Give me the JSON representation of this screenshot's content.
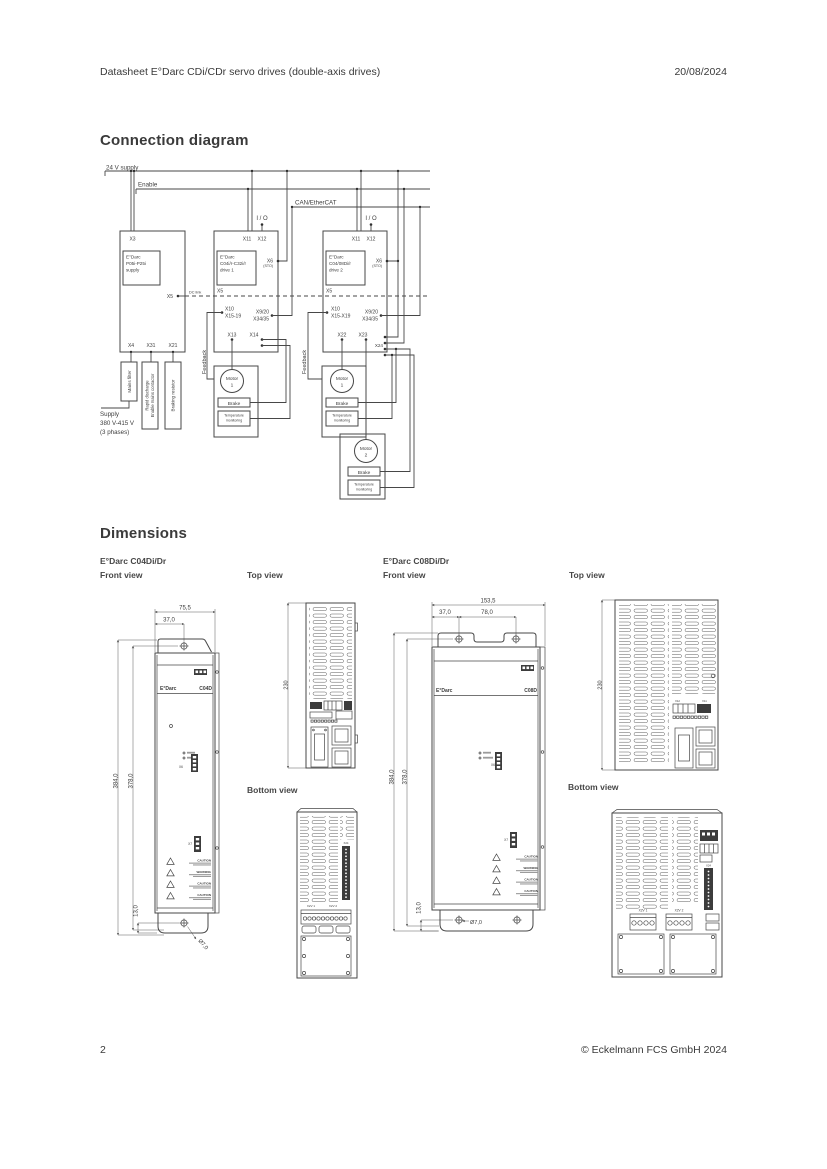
{
  "header": {
    "title": "Datasheet E°Darc CDi/CDr servo drives (double-axis drives)",
    "date": "20/08/2024"
  },
  "sections": {
    "connection": "Connection diagram",
    "dimensions": "Dimensions"
  },
  "footer": {
    "page": "2",
    "copyright": "© Eckelmann FCS GmbH 2024"
  },
  "diagram": {
    "bus": {
      "supply24": "24 V supply",
      "enable": "Enable",
      "can": "CAN/EtherCAT",
      "io1": "I / O",
      "io2": "I / O",
      "dc_link": "DC link"
    },
    "supply": {
      "x3": "X3",
      "name1": "E°Darc",
      "name2": "P05i-P25i",
      "name3": "supply",
      "x5": "X5",
      "x4": "X4",
      "x31": "X31",
      "x21": "X21"
    },
    "acc": {
      "mains_filter": "Mains filter",
      "rapid1": "Rapid discharge",
      "rapid2": "Enable mains contactor",
      "braking": "Braking resistor",
      "supply1": "Supply",
      "supply2": "380 V-415 V",
      "supply3": "(3 phases)"
    },
    "d1": {
      "x11": "X11",
      "x12": "X12",
      "name1": "E°Darc",
      "name2": "C04i/r-C32i/r",
      "name3": "drive 1",
      "x6": "X6",
      "sto": "(STO)",
      "x5": "X5",
      "x10": "X10",
      "x15": "X15-19",
      "x920": "X9/20",
      "x3435": "X34/35",
      "x13": "X13",
      "x14": "X14",
      "feedback": "Feedback"
    },
    "d2": {
      "x11": "X11",
      "x12": "X12",
      "name1": "E°Darc",
      "name2": "C04/08Di/r",
      "name3": "drive 2",
      "x6": "X6",
      "sto": "(STO)",
      "x5": "X5",
      "x10": "X10",
      "x15": "X15-X19",
      "x920": "X9/20",
      "x3435": "X34/35",
      "x22": "X22",
      "x23": "X23",
      "x24": "X24",
      "feedback": "Feedback"
    },
    "motor": {
      "label": "Motor",
      "n1": "1",
      "n2": "2",
      "brake": "Brake",
      "temp1": "Temperature",
      "temp2": "monitoring"
    }
  },
  "dim": {
    "c04d": {
      "model": "E°Darc C04Di/Dr",
      "front_view": "Front view",
      "top_view": "Top view",
      "bottom_view": "Bottom view",
      "front": {
        "w": "75,5",
        "off": "37,0",
        "h1": "384,0",
        "h2": "378,0",
        "b": "13,0",
        "dia": "Ø7,0",
        "brand": "E°Darc",
        "model": "C04D",
        "x6": "X6",
        "x7": "X7",
        "w1": "CAUTION",
        "w2": "WARNING",
        "w3": "CAUTION",
        "w4": "CAUTION"
      },
      "top": {
        "depth": "230"
      },
      "bottom": {
        "x24": "X24",
        "c1": "X2V 1",
        "c2": "X2V 2"
      }
    },
    "c08d": {
      "model": "E°Darc C08Di/Dr",
      "front_view": "Front view",
      "top_view": "Top view",
      "bottom_view": "Bottom view",
      "front": {
        "w": "153,5",
        "off": "37,0",
        "spacing": "78,0",
        "h1": "384,0",
        "h2": "378,0",
        "b": "13,0",
        "dia": "Ø7,0",
        "brand": "E°Darc",
        "model": "C08D",
        "x6": "X6",
        "x7": "X7",
        "w1": "CAUTION",
        "w2": "WARNING",
        "w3": "CAUTION",
        "w4": "CAUTION"
      },
      "top": {
        "depth": "230",
        "x12": "X12",
        "x11": "X11"
      },
      "bottom": {
        "x24": "X24",
        "c1": "X2V 1",
        "c2": "X2V 2"
      }
    }
  }
}
